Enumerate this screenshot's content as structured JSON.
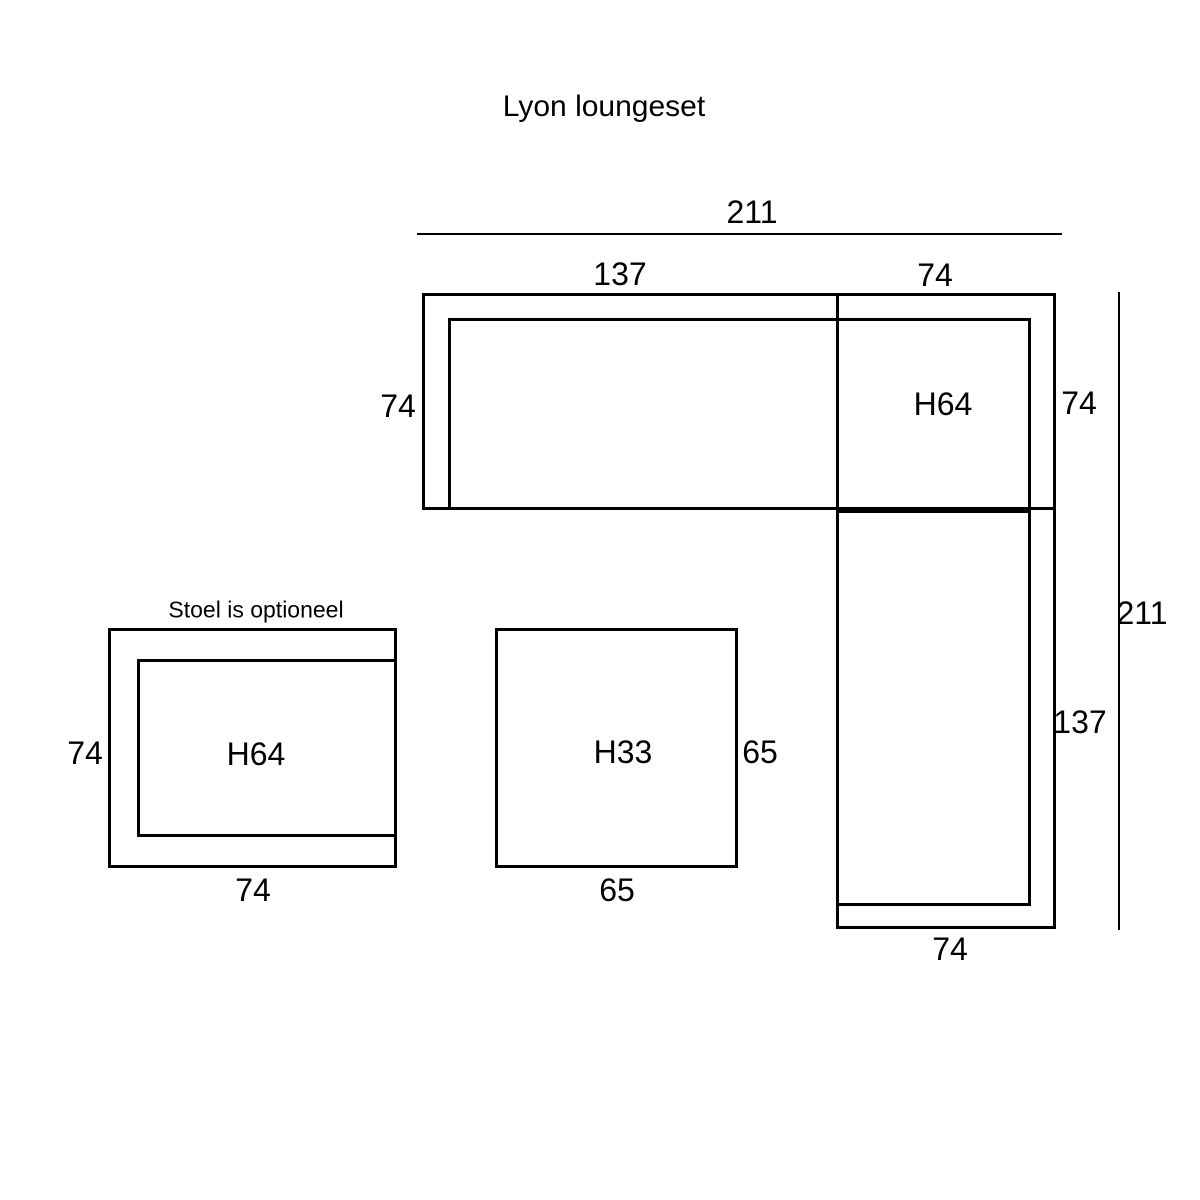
{
  "page": {
    "title": "Lyon loungeset",
    "background_color": "#ffffff",
    "line_color": "#000000"
  },
  "sofa": {
    "description": "corner lounge sofa, L-shaped, top-right of diagram",
    "labels": {
      "total_width": "211",
      "seat_section_width": "137",
      "corner_section_width": "74",
      "left_depth": "74",
      "seat_height": "H64",
      "right_depth": "74",
      "total_depth": "211",
      "side_section_length": "137",
      "bottom_width": "74"
    }
  },
  "chair": {
    "description": "optional chair, bottom-left of diagram",
    "note": "Stoel is optioneel",
    "labels": {
      "left_depth": "74",
      "seat_height": "H64",
      "bottom_width": "74"
    }
  },
  "table": {
    "description": "square coffee table, bottom-center of diagram",
    "labels": {
      "table_height": "H33",
      "right_depth": "65",
      "bottom_width": "65"
    }
  }
}
